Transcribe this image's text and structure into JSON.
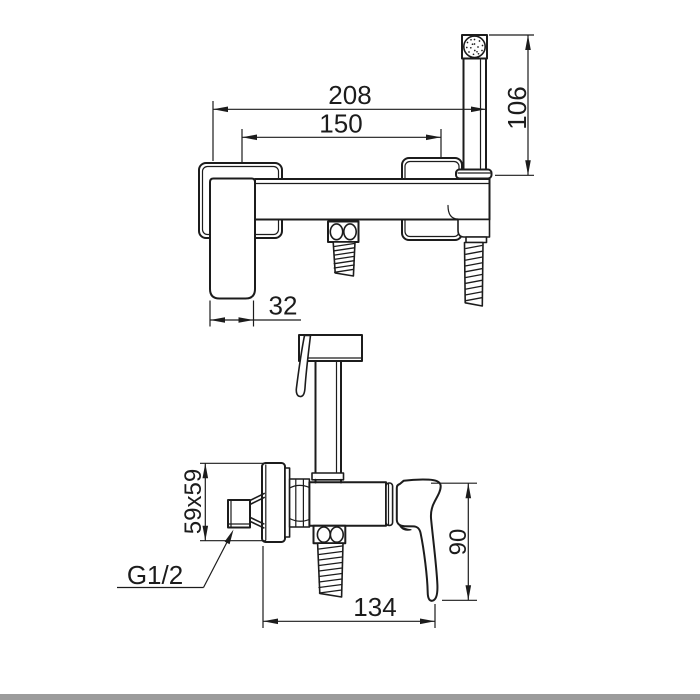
{
  "colors": {
    "line": "#1c1c1c",
    "background": "#ffffff",
    "footer_bar": "#9c9c9c"
  },
  "front_view": {
    "dims": {
      "overall_width": "208",
      "connection_centers": "150",
      "hand_shower_height": "106",
      "handle_width": "32"
    }
  },
  "side_view": {
    "dims": {
      "wall_plate_size": "59x59",
      "inlet_thread": "G1/2",
      "lever_height": "90",
      "projection_depth": "134"
    }
  }
}
